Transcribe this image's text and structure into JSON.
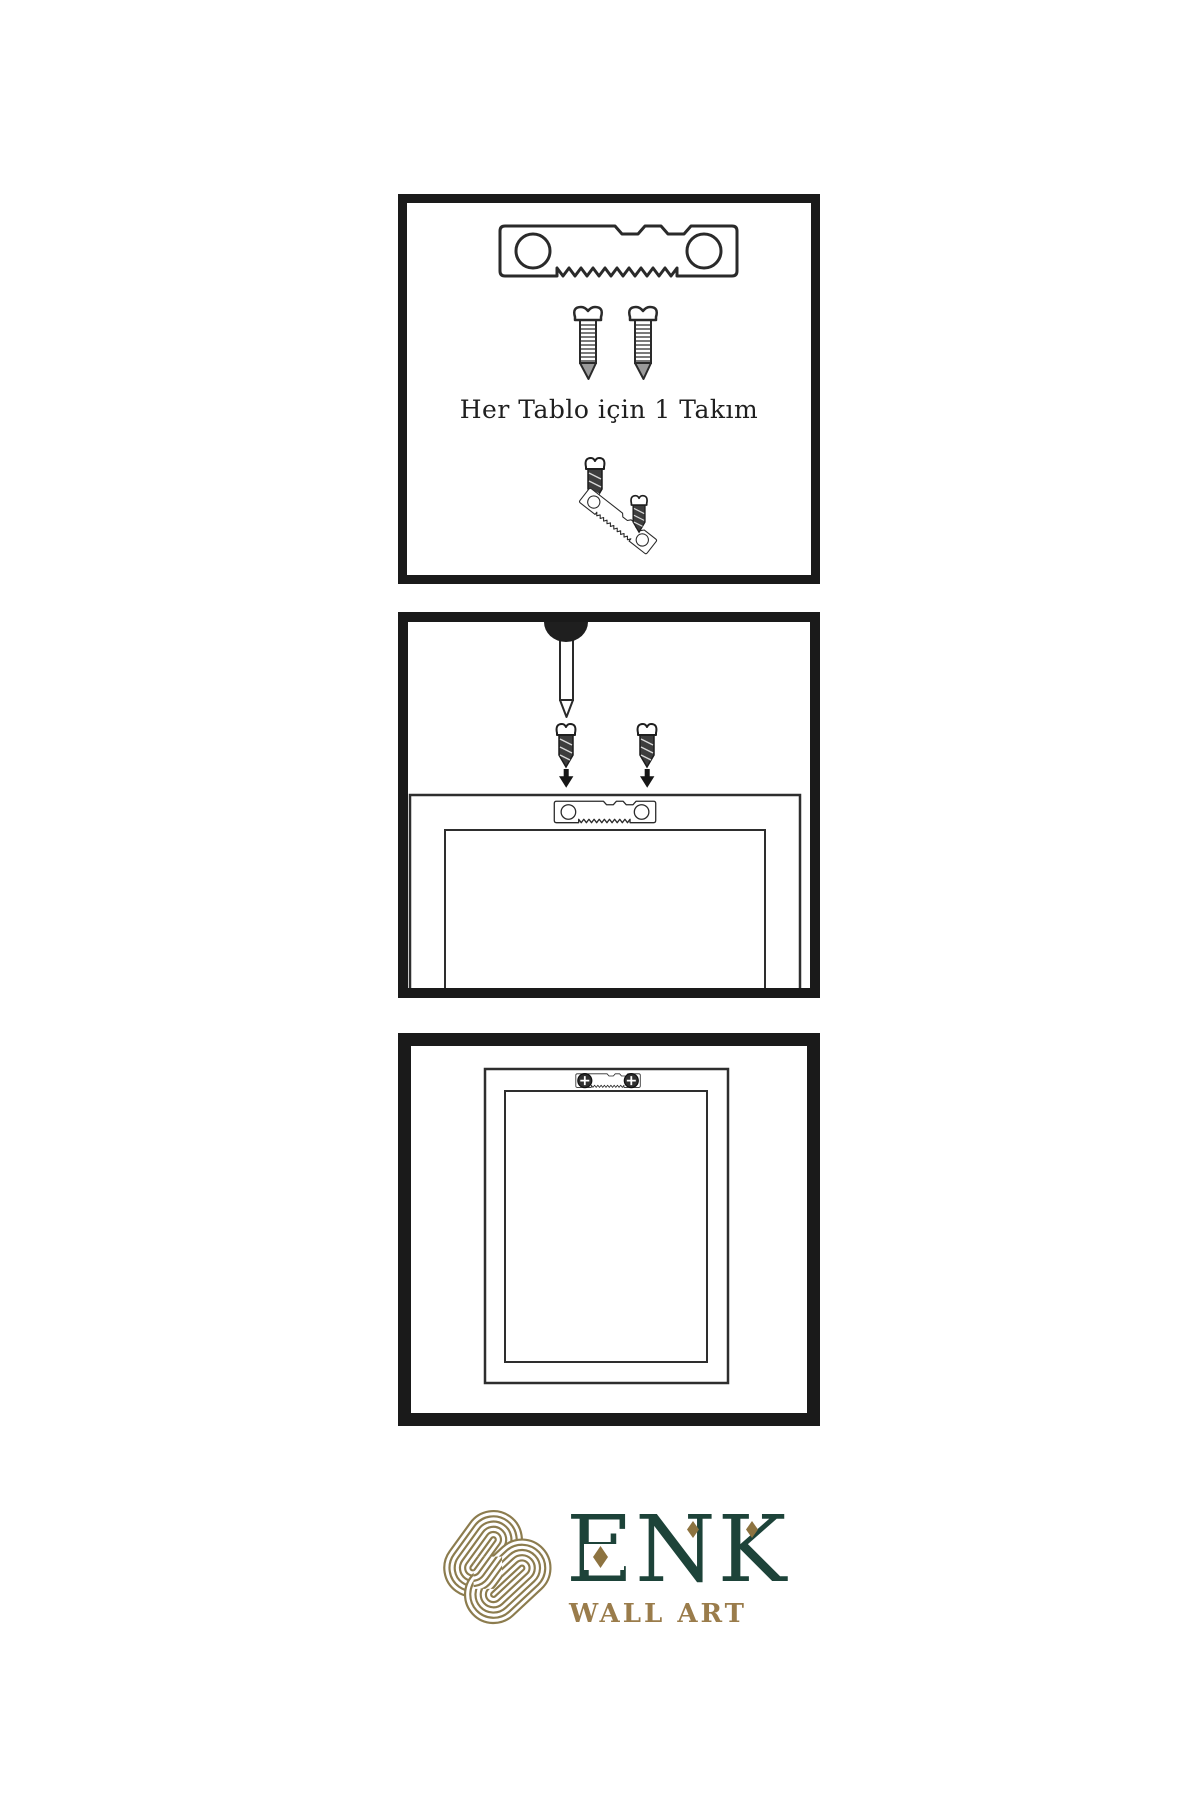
{
  "page": {
    "background": "#ffffff"
  },
  "panels": {
    "kit": {
      "caption": "Her Tablo için 1 Takım"
    },
    "install": {
      "description": "nail in wall, two screws with arrows pointing to sawtooth hanger on frame back"
    },
    "result": {
      "description": "sawtooth hanger screwed onto back of frame"
    }
  },
  "logo": {
    "title": "ENK",
    "subtitle": "WALL ART"
  },
  "colors": {
    "panel_border": "#1a1a1a",
    "line_art": "#2a2a2a",
    "screw_shaft_dark": "#3d3d3d",
    "brand_green": "#1d4339",
    "brand_gold_icon": "#8c7c4e",
    "brand_gold_text": "#9a7c4b",
    "diamond_gold": "#8d7340"
  }
}
